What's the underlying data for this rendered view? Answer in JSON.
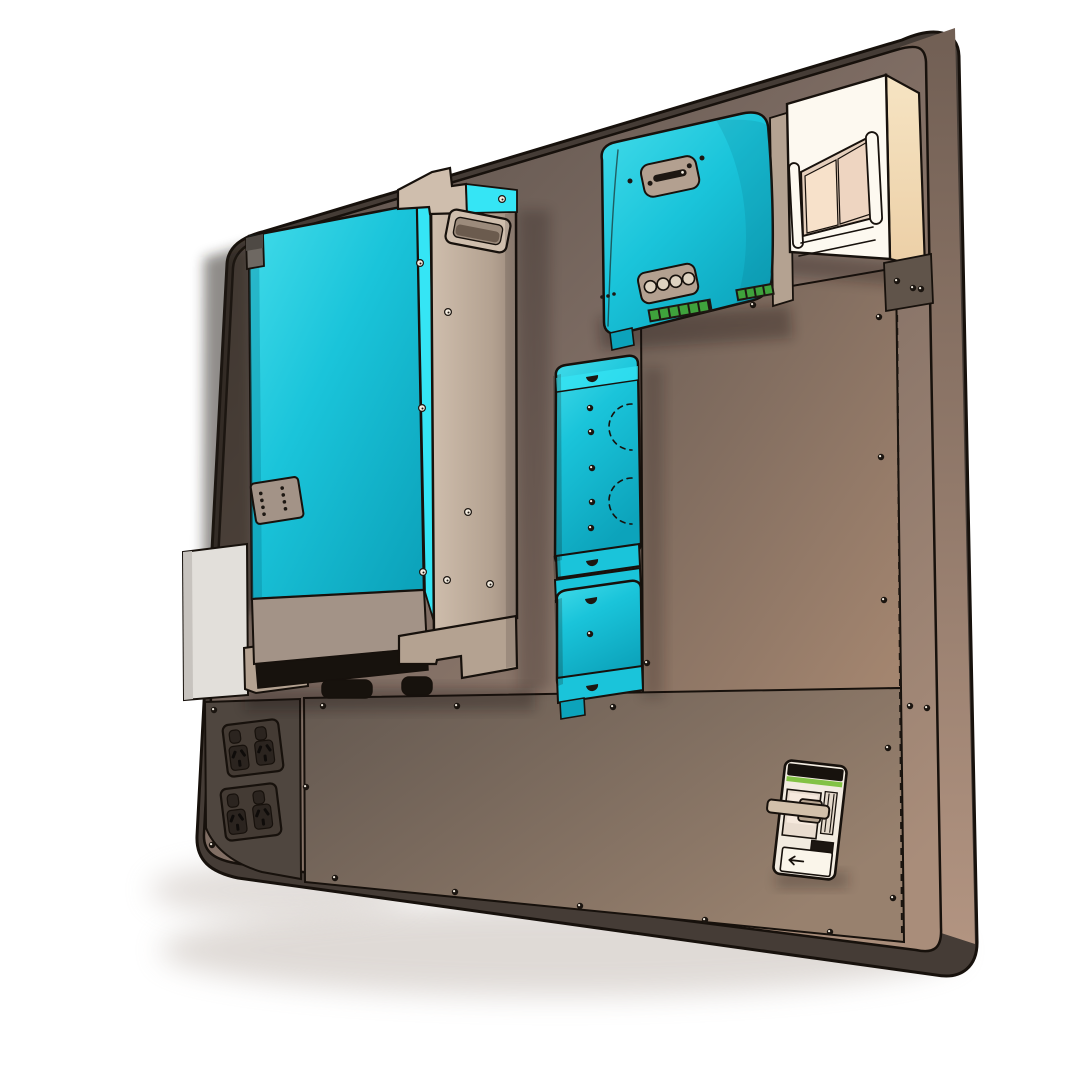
{
  "scene": {
    "title": "wall-mounted off-grid power system 3d render",
    "background": "#ffffff"
  },
  "components": {
    "backboard": {
      "name": "mounting-backboard",
      "shape": "rounded-rectangle"
    },
    "inverter": {
      "name": "inverter-charger",
      "status_led_columns": 2,
      "status_led_rows": 4,
      "side_handle": true
    },
    "charge_controller": {
      "name": "solar-charge-controller",
      "connector_holes": 4,
      "indicator_leds": 3
    },
    "breaker_enclosure": {
      "name": "din-breaker-enclosure",
      "window_modules": 2
    },
    "dc_boxes": {
      "name": "dc-junction-boxes",
      "count": 2
    },
    "power_outlets": {
      "name": "double-power-outlets",
      "count": 2,
      "sockets_per_outlet": 2
    },
    "isolator_breaker": {
      "name": "main-isolator-breaker",
      "stripe": "green",
      "toggle_direction": "left"
    },
    "side_enclosure": {
      "name": "left-side-enclosure-panel"
    }
  },
  "colors": {
    "background": "#ffffff",
    "outline": "#17110c",
    "board": {
      "dark": "#544b45",
      "mid": "#7b6a61",
      "light": "#a98d7a",
      "side_bottom": "#453c36",
      "side_right_top": "#715f54",
      "side_right_bottom": "#b29481"
    },
    "panels": {
      "right_dark": "#6f6057",
      "right_light": "#a3856f",
      "lower_dark": "#635850",
      "lower_light": "#98816e",
      "outlet_panel": "#4f463f",
      "bracket": "#60544a"
    },
    "cyan": {
      "light": "#43dcea",
      "main": "#1ac4da",
      "dark": "#0ca3bb",
      "strip": "#35e5f5"
    },
    "beige": {
      "light": "#cfbead",
      "mid": "#b4a291",
      "dark": "#9b897c",
      "band": "#a39387"
    },
    "vent": "#17120d",
    "white_box": {
      "front": "#fdf9f0",
      "side_light": "#f6e4c3",
      "side_dark": "#eccfa6",
      "window_left": "#f7e1ca",
      "window_right": "#eed5c1",
      "recess": "#e5cfbc"
    },
    "left_box": "#e2dfda",
    "outlet": {
      "body": "#443b34",
      "socket": "#2b241f",
      "slot": "#0f0c0a"
    },
    "breaker": {
      "face": "#f2ebe0",
      "recess": "#e9dccf",
      "glow": "#f6e9dd",
      "toggle": "#d2c0aa",
      "black_band": "#17120d",
      "green_stripe": "#82c244",
      "label_plate": "#faf5ea",
      "label_dark": "#1c1611"
    },
    "mppt_plate": "#b3a090",
    "terminal_green": "#3fa23c",
    "hole_fill": "#ded2c0",
    "screw_dark": "#1b1510",
    "screw_light": "#f2ebdf"
  }
}
